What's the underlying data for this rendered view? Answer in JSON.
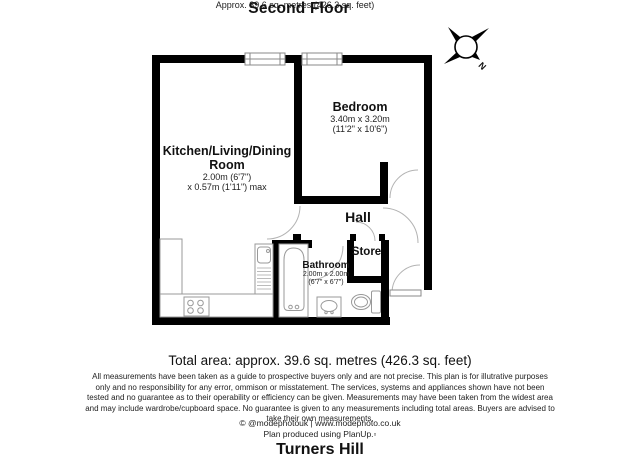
{
  "header": {
    "title": "Second Floor",
    "subtitle": "Approx. 39.6 sq. metres (426.3 sq. feet)"
  },
  "compass": {
    "north_label": "N"
  },
  "rooms": {
    "kitchen": {
      "name_line1": "Kitchen/Living/Dining",
      "name_line2": "Room",
      "dim1": "2.00m (6'7\")",
      "dim2": "x 0.57m (1'11\") max"
    },
    "bedroom": {
      "name": "Bedroom",
      "dim1": "3.40m x 3.20m",
      "dim2": "(11'2\" x 10'6\")"
    },
    "hall": {
      "name": "Hall"
    },
    "store": {
      "name": "Store"
    },
    "bathroom": {
      "name": "Bathroom",
      "dim1": "2.00m x 2.00m",
      "dim2": "(6'7\" x 6'7\")"
    }
  },
  "footer": {
    "total_area": "Total area: approx. 39.6 sq. metres (426.3 sq. feet)",
    "disclaimer": "All measurements have been taken as a guide to prospective buyers only and are not precise. This plan is for illutrative purposes only and no responsibility for any error, ommison or misstatement. The services, systems and appliances shown have not been tested and no guarantee as to their operability or efficiency can be given. Measurements may have been taken from the widest area and may include wardrobe/cupboard space. No guarantee is given to any measurements including total areas. Buyers are advised to take their own measurements.",
    "copyright": "© @modephotouk | www.modephoto.co.uk",
    "produced_by": "Plan produced using PlanUp.▫",
    "location": "Turners Hill"
  },
  "colors": {
    "wall": "#000000",
    "fixture_outline": "#999999",
    "door_arc": "#b3b3b3"
  }
}
